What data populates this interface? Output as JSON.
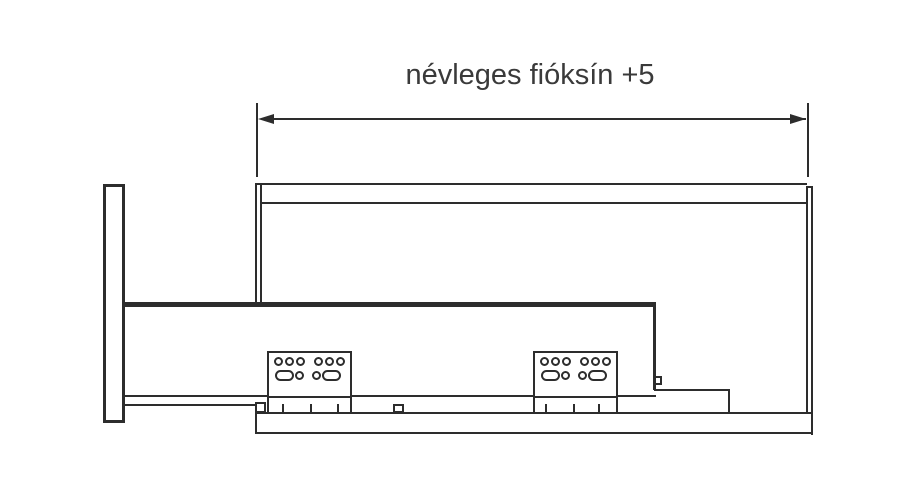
{
  "page": {
    "background_color": "#ffffff",
    "line_color": "#2d2d2d",
    "text_color": "#3a3a3a"
  },
  "annotation": {
    "dimension_label": "névleges fióksín +5"
  },
  "diagram": {
    "type": "technical-line-drawing",
    "subject": "drawer slide (fióksín) side-view mounting drawing",
    "dimension": {
      "label": "névleges fióksín +5",
      "measures": "nominal rail length between cabinet front edge and cabinet back"
    },
    "components": [
      {
        "name": "drawer-front-panel",
        "description": "tall vertical panel at left"
      },
      {
        "name": "cabinet-top-panel",
        "description": "double horizontal line across the top"
      },
      {
        "name": "cabinet-front-edge",
        "description": "double vertical line at left of carcass"
      },
      {
        "name": "cabinet-back-panel",
        "description": "double vertical line at right of carcass"
      },
      {
        "name": "drawer-rail-body",
        "description": "long rail with thick top flange"
      },
      {
        "name": "mounting-plate-front",
        "holes": {
          "top_row_round": 6,
          "bottom_row": [
            "slot",
            "round",
            "round",
            "slot"
          ]
        }
      },
      {
        "name": "mounting-plate-rear",
        "holes": {
          "top_row_round": 6,
          "bottom_row": [
            "slot",
            "round",
            "round",
            "slot"
          ]
        }
      },
      {
        "name": "cabinet-runner-profile",
        "description": "lower horizontal rail with front hook and rear bracket"
      }
    ]
  }
}
